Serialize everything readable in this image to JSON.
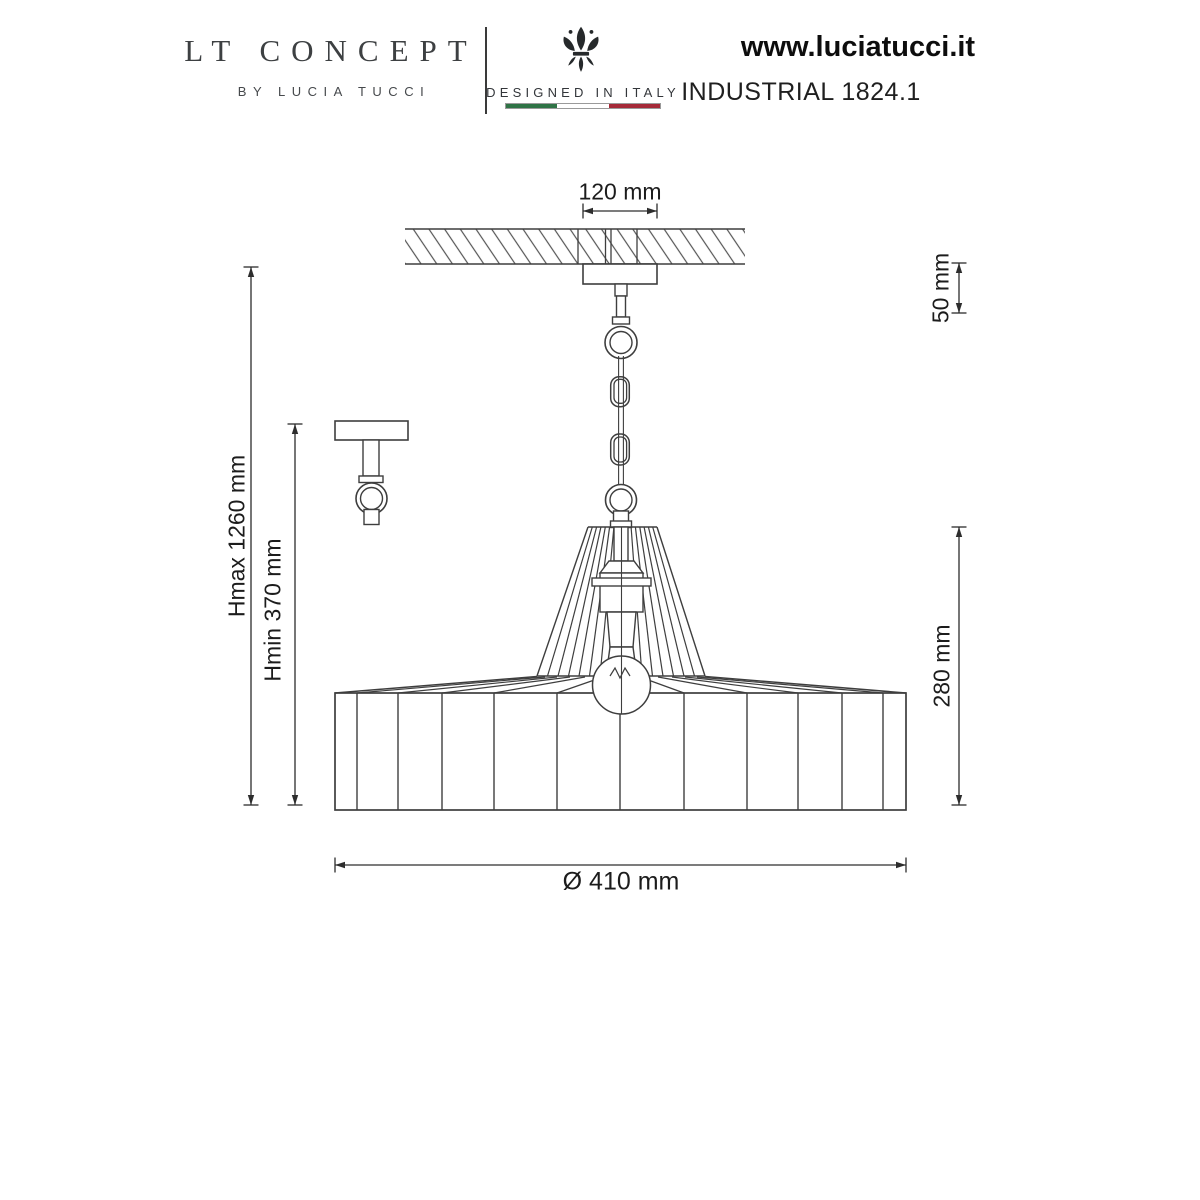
{
  "header": {
    "brand": {
      "title": "LT CONCEPT",
      "subtitle": "BY LUCIA TUCCI"
    },
    "origin": {
      "icon": "fleur-de-lis",
      "label": "DESIGNED IN ITALY",
      "flag_colors": {
        "green": "#2f7346",
        "white": "#ffffff",
        "red": "#a52a38"
      }
    },
    "site": {
      "url": "www.luciatucci.it",
      "model": "INDUSTRIAL 1824.1"
    }
  },
  "drawing": {
    "type": "pendant-lamp-technical-drawing",
    "line_color": "#3e3e3e",
    "dims": {
      "canopy_width": "120 mm",
      "suspension_top": "50 mm",
      "h_max": "Hmax 1260 mm",
      "h_min": "Hmin 370 mm",
      "shade_height": "280 mm",
      "diameter": "Ø 410 mm"
    }
  }
}
